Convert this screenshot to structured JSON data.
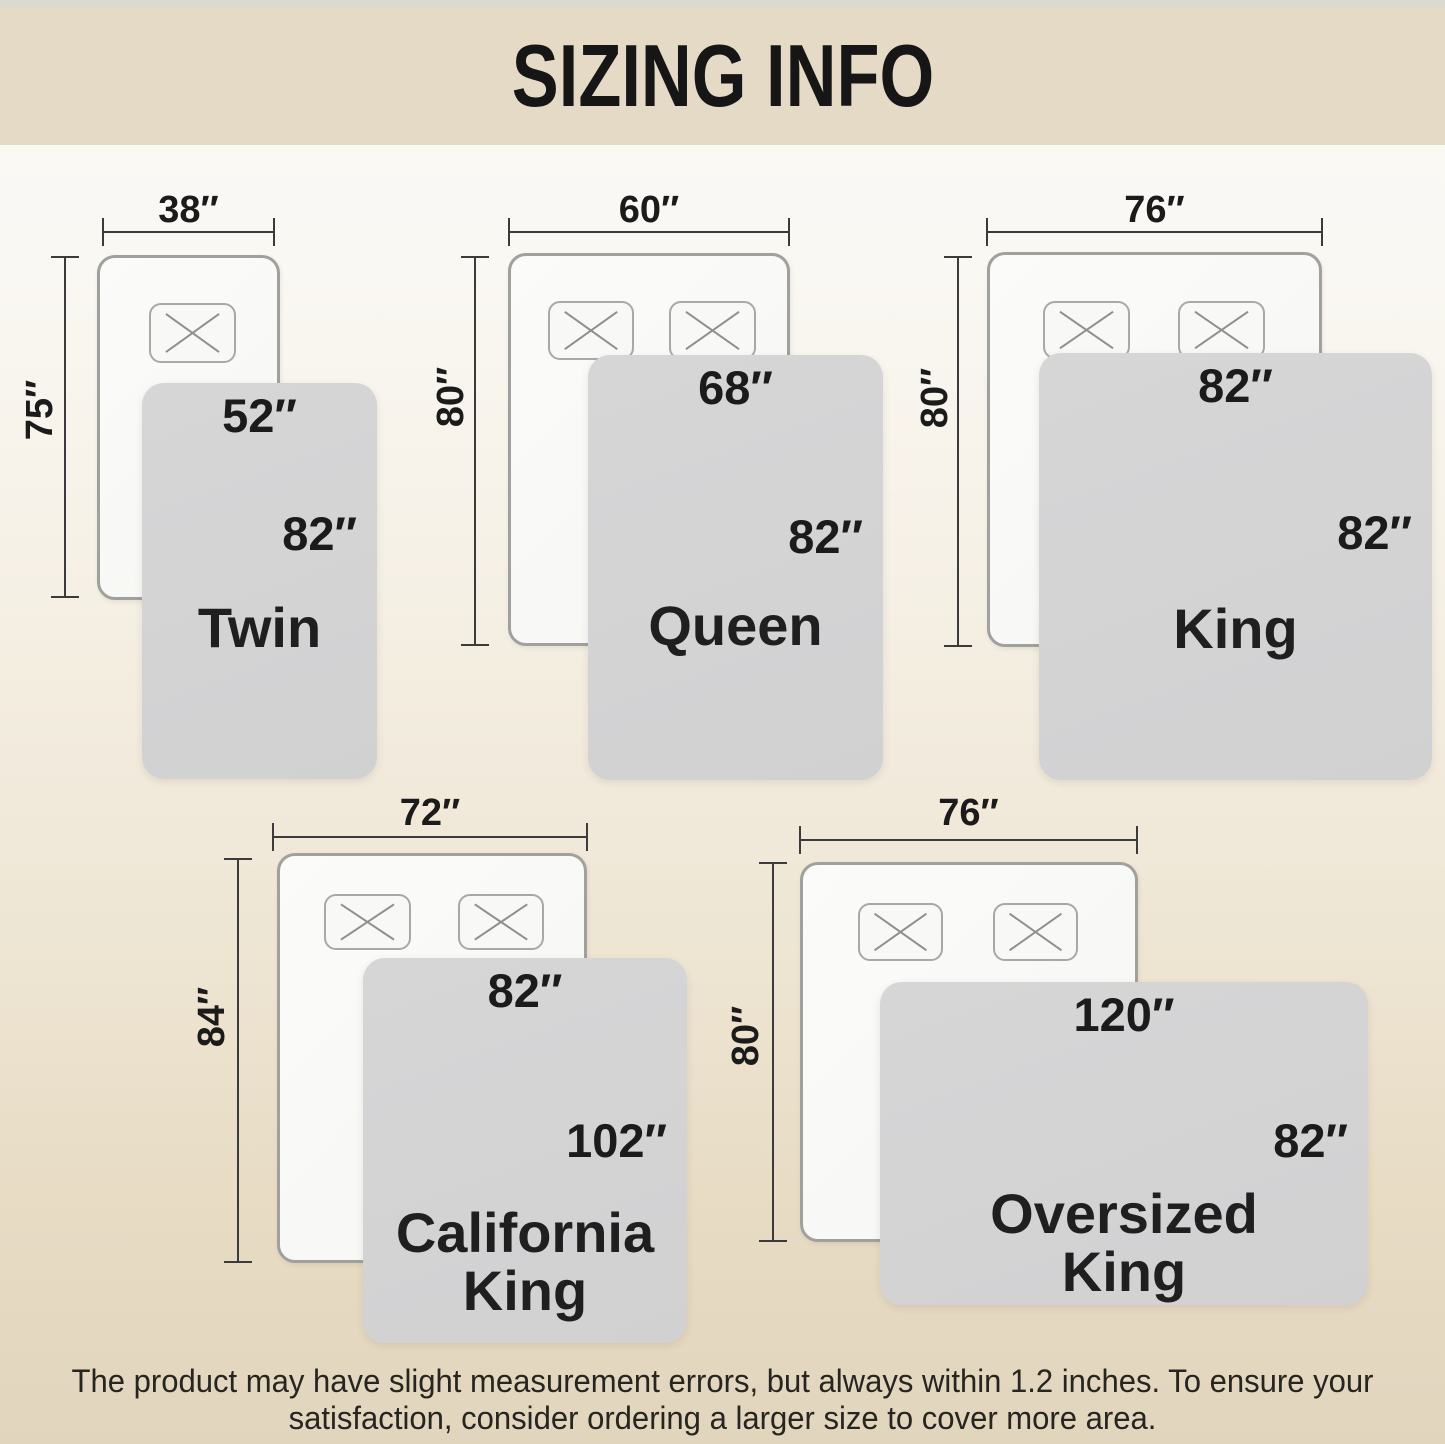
{
  "title": "SIZING INFO",
  "sizes": [
    {
      "name_line1": "Twin",
      "name_line2": "",
      "bed_width": "38″",
      "bed_length": "75″",
      "blanket_width": "52″",
      "blanket_length": "82″"
    },
    {
      "name_line1": "Queen",
      "name_line2": "",
      "bed_width": "60″",
      "bed_length": "80″",
      "blanket_width": "68″",
      "blanket_length": "82″"
    },
    {
      "name_line1": "King",
      "name_line2": "",
      "bed_width": "76″",
      "bed_length": "80″",
      "blanket_width": "82″",
      "blanket_length": "82″"
    },
    {
      "name_line1": "California",
      "name_line2": "King",
      "bed_width": "72″",
      "bed_length": "84″",
      "blanket_width": "82″",
      "blanket_length": "102″"
    },
    {
      "name_line1": "Oversized",
      "name_line2": "King",
      "bed_width": "76″",
      "bed_length": "80″",
      "blanket_width": "120″",
      "blanket_length": "82″"
    }
  ],
  "footnote": {
    "line1": "The product may have slight measurement errors, but always within 1.2 inches. To ensure your",
    "line2": "satisfaction, consider ordering a larger size to cover more area."
  },
  "colors": {
    "header_bg": "#e5dac6",
    "background_bottom": "#e2d5be",
    "blanket": "#d3d3d4",
    "bed_fill": "#f9f9f7",
    "bed_border": "#a0a09d",
    "dimension_line": "#3b3b3b",
    "label_text": "#1b1b1b"
  }
}
